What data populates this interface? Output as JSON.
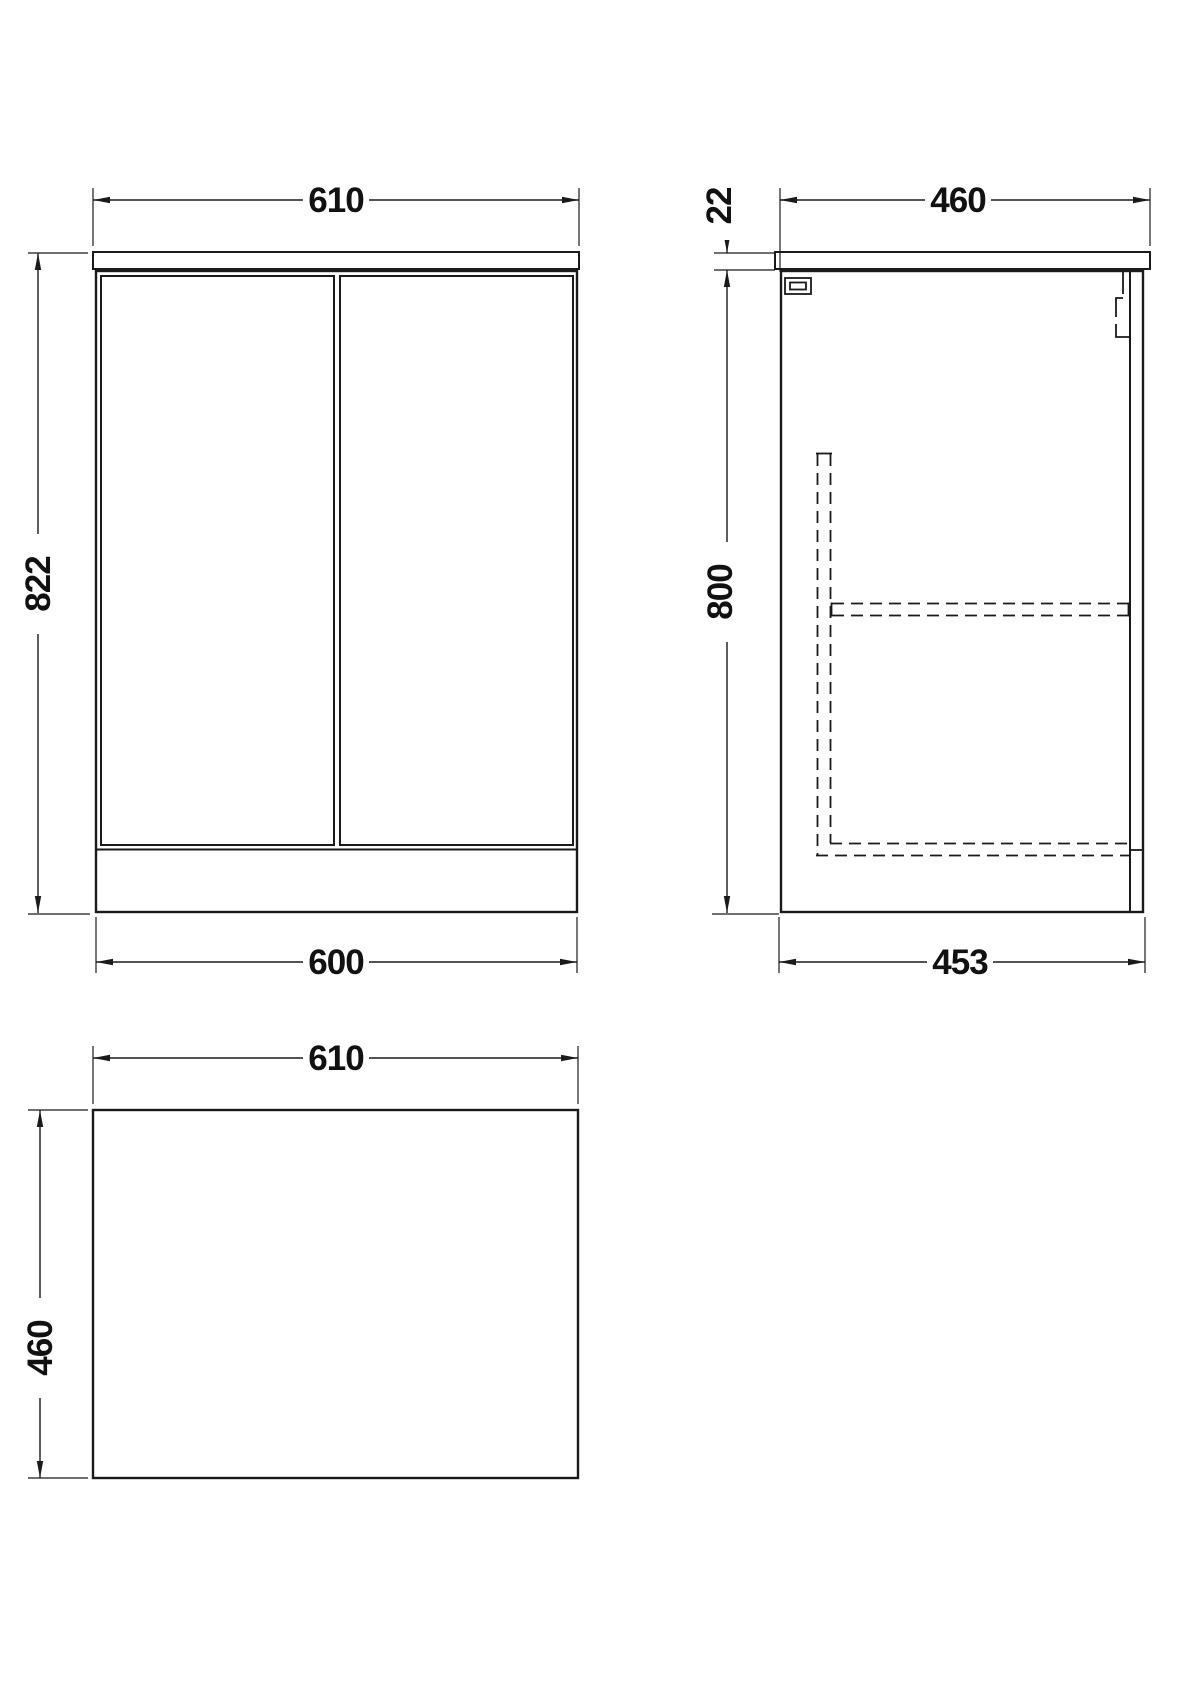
{
  "drawing": {
    "type": "technical-dimension-drawing",
    "units_shown": "mm",
    "colors": {
      "line": "#1a1a1a",
      "background": "#ffffff"
    },
    "views": {
      "front": {
        "name": "front-elevation",
        "width_top": "610",
        "height": "822",
        "width_bottom": "600"
      },
      "side": {
        "name": "side-section",
        "depth_top": "460",
        "counter_thickness": "22",
        "height": "800",
        "depth_bottom": "453"
      },
      "plan": {
        "name": "plan-view",
        "width": "610",
        "depth": "460"
      }
    }
  }
}
